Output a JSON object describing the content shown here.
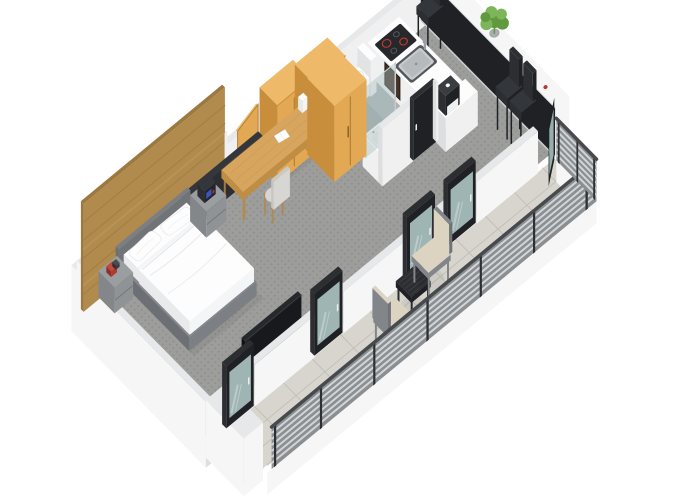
{
  "scene": {
    "kind": "isometric-3d-floor-plan-render",
    "background": "#ffffff",
    "rooms": [
      "bedroom",
      "bathroom",
      "kitchen",
      "dining-bar",
      "balcony"
    ],
    "inventory": {
      "bedroom": [
        "double-bed",
        "white-pillows",
        "gray-nightstand-left",
        "gray-nightstand-right",
        "clock-radio",
        "red-books",
        "wood-slat-accent-wall",
        "entry-door",
        "wardrobe-1",
        "wardrobe-2",
        "tall-cabinet",
        "wooden-desk",
        "desk-chair",
        "notebook",
        "tv-panel"
      ],
      "bathroom": [
        "glass-shower",
        "shower-head",
        "toilet",
        "washbasin",
        "mirror-cabinet",
        "bathroom-door"
      ],
      "kitchen": [
        "kitchen-counter",
        "induction-hob",
        "steel-sink",
        "faucet",
        "coffee-machine"
      ],
      "dining_bar": [
        "bar-counter",
        "bar-stool-1",
        "bar-stool-2",
        "bar-stool-3",
        "potted-plant",
        "red-cup"
      ],
      "balcony": [
        "glass-door-1",
        "glass-door-2",
        "glass-door-3",
        "glass-door-4",
        "open-glass-door",
        "outdoor-chair-1",
        "outdoor-chair-2",
        "outdoor-side-table",
        "railing",
        "stone-tile-floor"
      ]
    },
    "counts": {
      "bar_stools": 3,
      "balcony_glass_doors": 5,
      "wardrobes": 2,
      "outdoor_chairs": 2,
      "nightstands": 2
    }
  },
  "palette": {
    "bg": "#ffffff",
    "wall_outer": "#f6f6f7",
    "wall_top": "#e7e8ea",
    "wall_inner": "#f0f0f1",
    "wall_shade": "#dddee0",
    "wood": "#b18a4d",
    "wood_dark": "#9d7940",
    "wood_light": "#c29a5f",
    "timber": "#e3a854",
    "timber_side": "#c88e3c",
    "timber_top": "#eeb969",
    "timber_line": "#a87830",
    "carpet": "#9d9d9b",
    "carpet_dot": "#8f8f8d",
    "bath_floor": "#adb1b4",
    "shower_floor": "#9da4a8",
    "balcony_tile": "#d8d5ce",
    "balcony_line": "#c3c0b9",
    "black": "#1f2124",
    "black_soft": "#2c2e31",
    "glass": "#a9c2c0",
    "glass_hi": "#cfdedd",
    "steel": "#c7cbcd",
    "steel_dark": "#999fa2",
    "bed_frame": "#7c7f83",
    "bed_frame_dark": "#6c6f73",
    "headboard": "#707377",
    "white": "#fdfdfe",
    "linen": "#e9eaec",
    "linen_mid": "#f4f5f7",
    "night": "#84878a",
    "night_front": "#909396",
    "night_top": "#9b9ea1",
    "seat": "#d7d6d2",
    "chair_gray": "#82868a",
    "cushion": "#dcd4c1",
    "rail_dark": "#8b8f92",
    "rail_light": "#d2d5d7",
    "rail_post": "#2d2f32",
    "rail_top": "#47494c",
    "plant": "#61993f",
    "plant_light": "#7db55b",
    "pot": "#a9aeb0",
    "red": "#b23a2d",
    "hob": "#26282b",
    "hob_ring": "#c43a2c",
    "oven": "#443129",
    "desk_wood": "#d7a55d",
    "desk_wood_dark": "#c08d45",
    "tv": "#17191c"
  }
}
